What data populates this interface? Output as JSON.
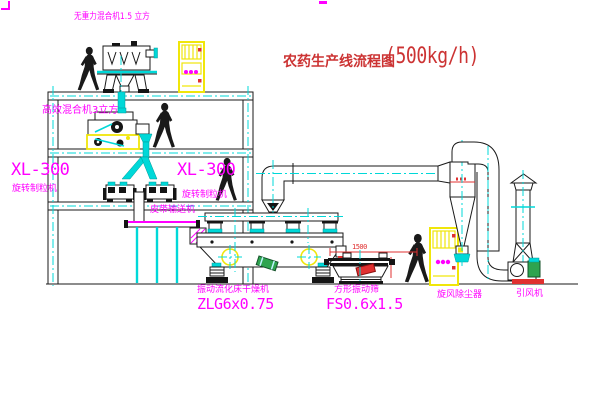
{
  "title": {
    "text": "农药生产线流程图",
    "capacity": "(500kg/h)"
  },
  "equipment": {
    "mixer1": {
      "label": "无重力混合机1.5 立方"
    },
    "mixer2": {
      "label": "高效混合机3立方"
    },
    "granulator_left": {
      "model": "XL-300",
      "name": "旋转制粒机"
    },
    "granulator_right": {
      "model": "XL-300",
      "name": "旋转制粒机"
    },
    "conveyor": {
      "label": "皮带输送机"
    },
    "dryer": {
      "name": "振动流化床干燥机",
      "model": "ZLG6x0.75"
    },
    "sieve": {
      "name": "方形振动筛",
      "model": "FS0.6x1.5",
      "dimension": "1500"
    },
    "cyclone": {
      "label": "旋风除尘器"
    },
    "fan": {
      "label": "引风机"
    }
  },
  "colors": {
    "line": "#1a1a1a",
    "accent_cyan": "#00d8d8",
    "accent_yellow": "#f0e60a",
    "label_magenta": "#ff00ff",
    "title_red": "#cc3333",
    "status_red": "#e03030"
  }
}
